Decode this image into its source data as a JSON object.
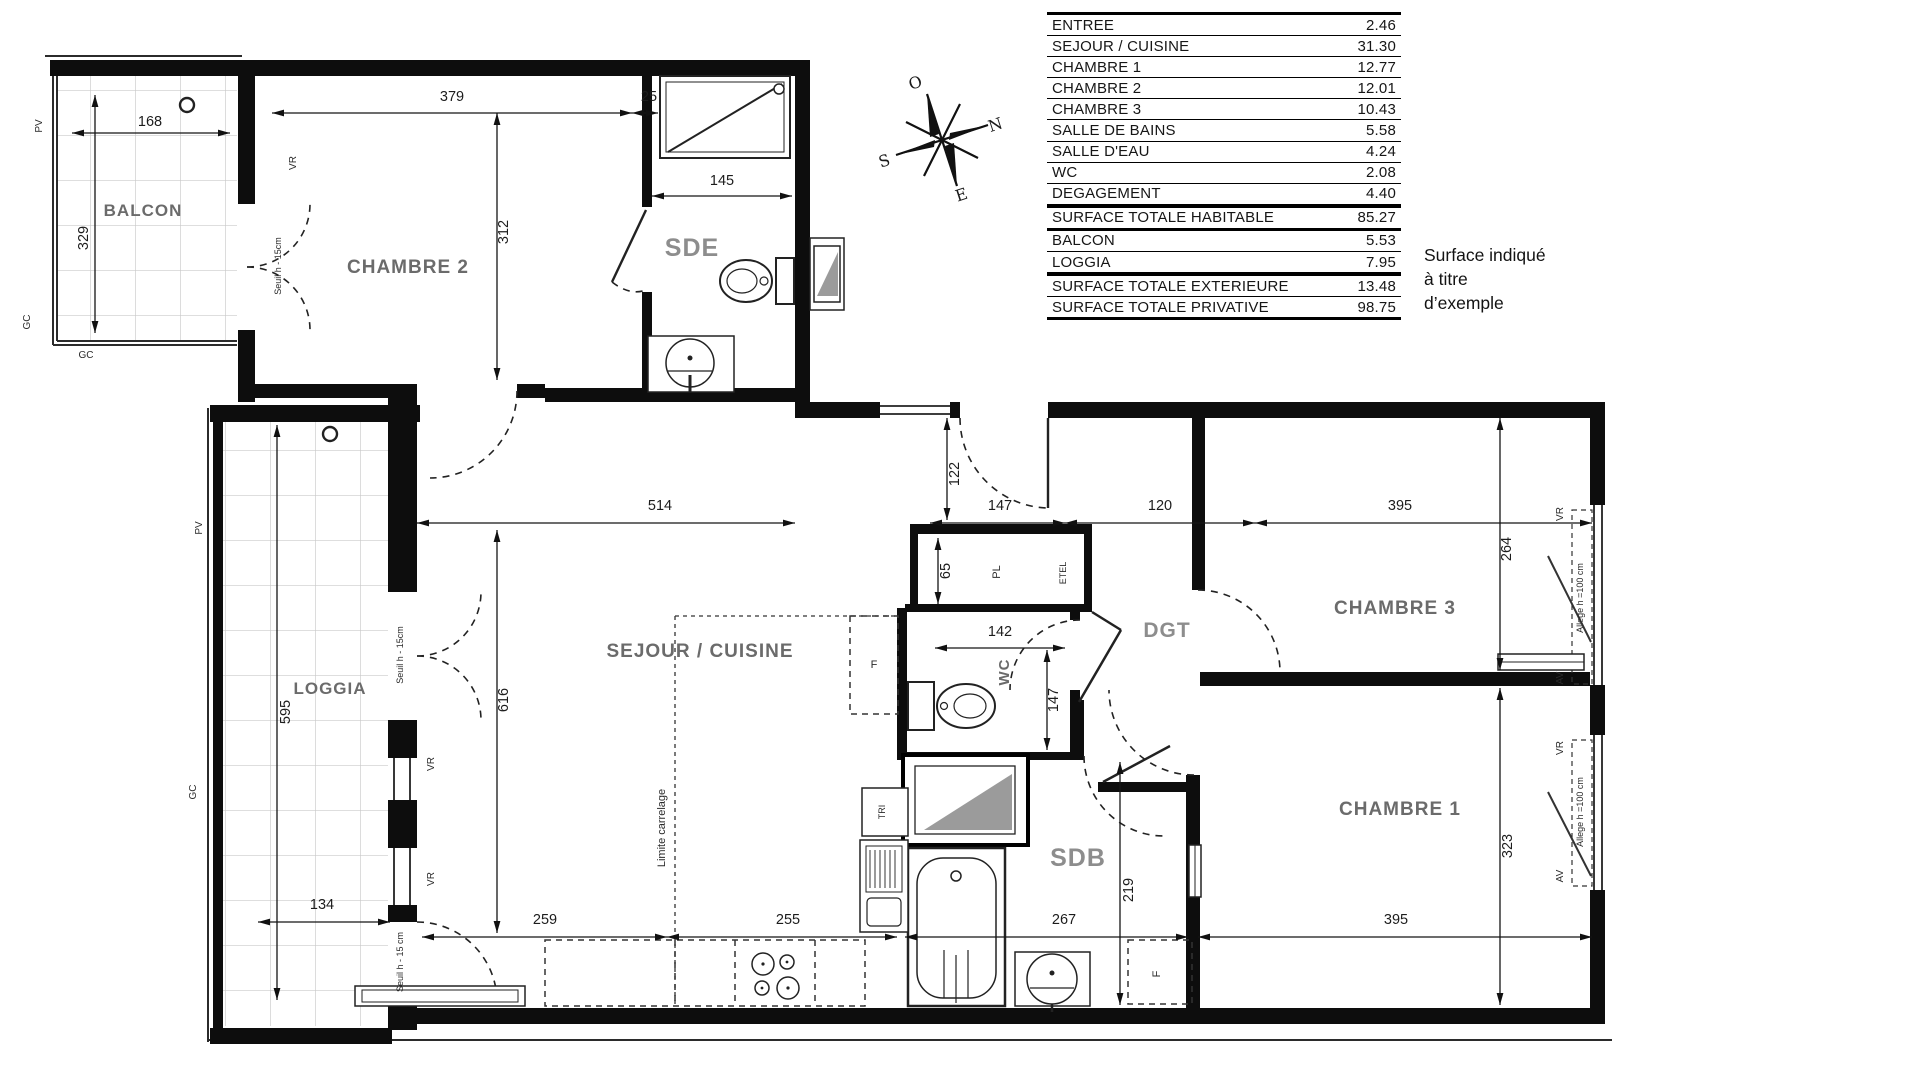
{
  "table": {
    "rows": [
      {
        "label": "ENTREE",
        "value": "2.46"
      },
      {
        "label": "SEJOUR / CUISINE",
        "value": "31.30"
      },
      {
        "label": "CHAMBRE 1",
        "value": "12.77"
      },
      {
        "label": "CHAMBRE 2",
        "value": "12.01"
      },
      {
        "label": "CHAMBRE 3",
        "value": "10.43"
      },
      {
        "label": "SALLE DE BAINS",
        "value": "5.58"
      },
      {
        "label": "SALLE D'EAU",
        "value": "4.24"
      },
      {
        "label": "WC",
        "value": "2.08"
      },
      {
        "label": "DEGAGEMENT",
        "value": "4.40"
      },
      {
        "label": "SURFACE TOTALE HABITABLE",
        "value": "85.27"
      },
      {
        "label": "BALCON",
        "value": "5.53"
      },
      {
        "label": "LOGGIA",
        "value": "7.95"
      },
      {
        "label": "SURFACE TOTALE EXTERIEURE",
        "value": "13.48"
      },
      {
        "label": "SURFACE TOTALE PRIVATIVE",
        "value": "98.75"
      }
    ]
  },
  "note": "Surface indiqué à titre d’exemple",
  "compass": {
    "o": "O",
    "n": "N",
    "s": "S",
    "e": "E"
  },
  "rooms": {
    "balcon": "BALCON",
    "chambre2": "CHAMBRE 2",
    "sde": "SDE",
    "loggia": "LOGGIA",
    "sejour": "SEJOUR / CUISINE",
    "wc": "WC",
    "dgt": "DGT",
    "chambre3": "CHAMBRE 3",
    "sdb": "SDB",
    "chambre1": "CHAMBRE 1"
  },
  "dims": {
    "balcon_w": "168",
    "balcon_h": "329",
    "ch2_w": "379",
    "ch2_off": "25",
    "ch2_h": "312",
    "sde_w": "145",
    "sejour_w": "514",
    "entry_h": "122",
    "entry_w": "147",
    "dgt_w": "120",
    "ch3_w": "395",
    "ch3_h": "264",
    "loggia_h": "595",
    "loggia_w": "134",
    "sejour_h": "616",
    "pl_d": "65",
    "wc_w": "142",
    "wc_d": "147",
    "kitchen_a": "259",
    "kitchen_b": "255",
    "sdb_w": "267",
    "sdb_h": "219",
    "ch1_w": "395",
    "ch1_h": "323"
  },
  "annotations": {
    "pv_balcon": "PV",
    "gc_balcon_side": "GC",
    "gc_balcon": "GC",
    "pv_loggia": "PV",
    "gc_loggia": "GC",
    "vr_ch2": "VR",
    "seuil_ch2": "Seuil h - 15cm",
    "seuil_loggia_1": "Seuil h - 15cm",
    "seuil_loggia_2": "Seuil h - 15 cm",
    "vr_sejour_1": "VR",
    "vr_sejour_2": "VR",
    "limite_carrelage": "Limite carrelage",
    "pl": "PL",
    "etel": "ETEL",
    "f_kitchen": "F",
    "tri": "TRI",
    "f_sdb": "F",
    "vr_ch3": "VR",
    "allege_ch3": "Allege h =100 cm",
    "av_ch3": "AV",
    "vr_ch1": "VR",
    "allege_ch1": "Allege h =100 cm",
    "av_ch1": "AV"
  },
  "colors": {
    "line": "#111111",
    "tile": "#c9c9c9",
    "fixture_gray": "#9b9b9b"
  }
}
